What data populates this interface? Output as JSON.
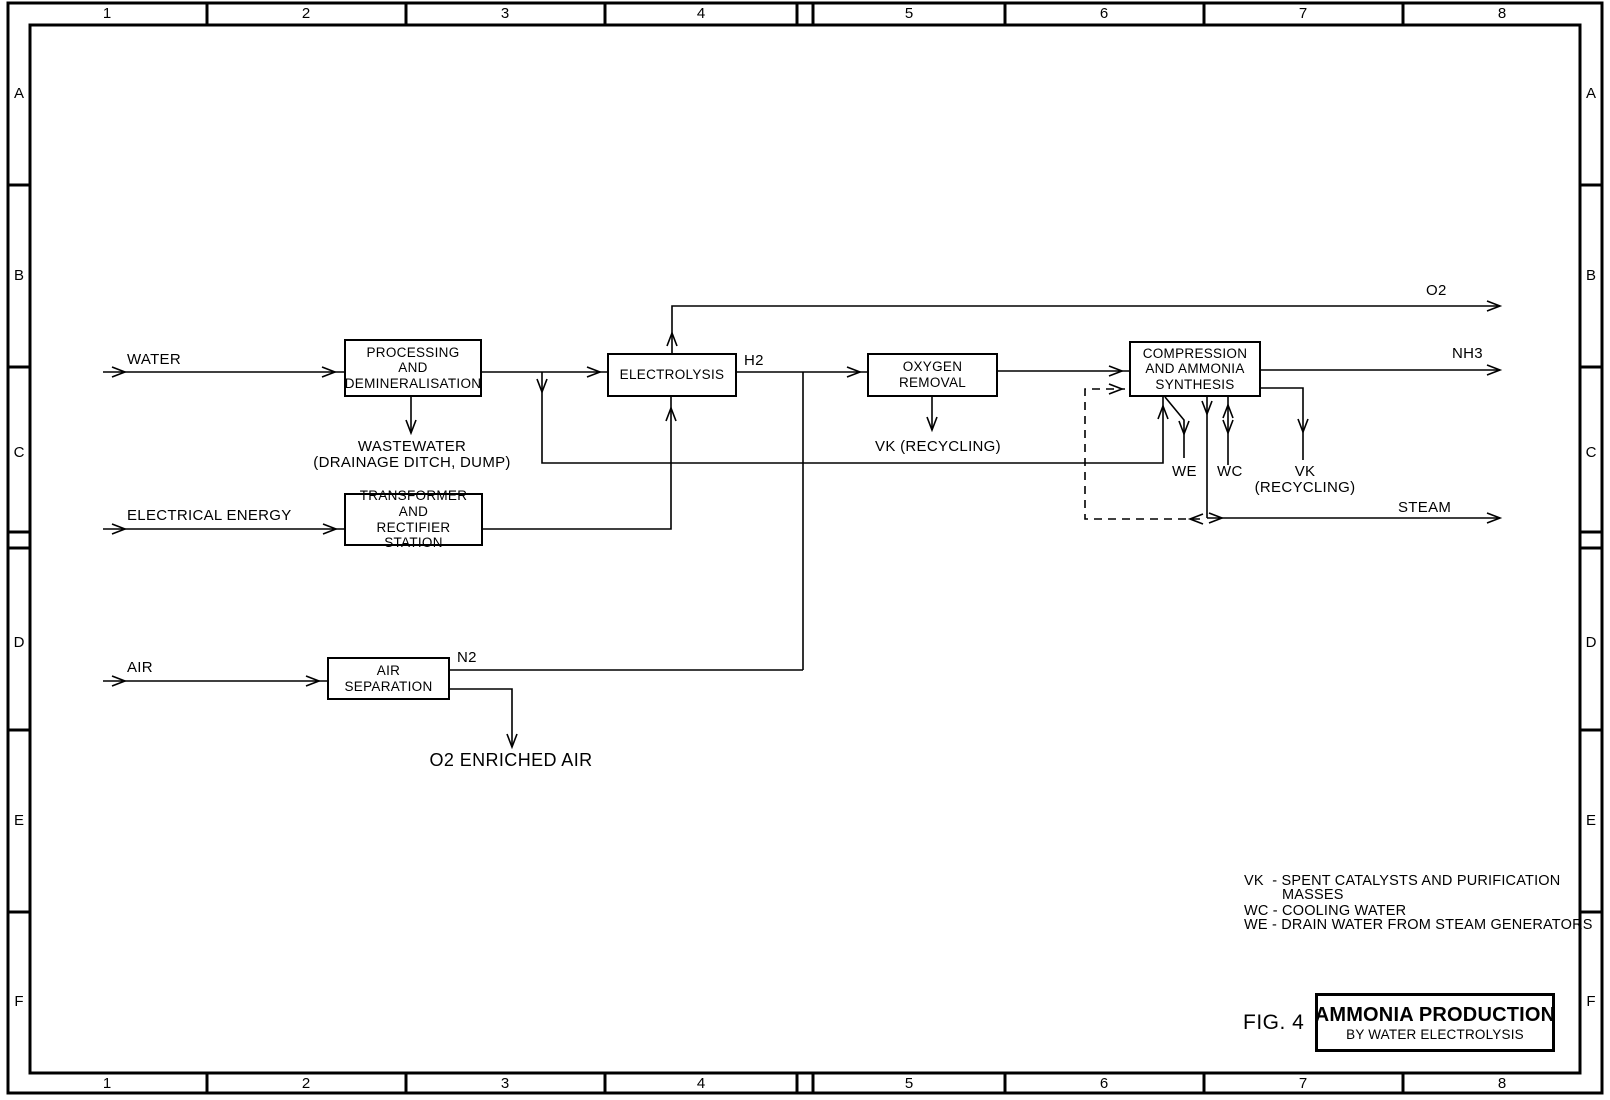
{
  "frame": {
    "top_numbers": [
      "1",
      "2",
      "3",
      "4",
      "5",
      "6",
      "7",
      "8"
    ],
    "bottom_numbers": [
      "1",
      "2",
      "3",
      "4",
      "5",
      "6",
      "7",
      "8"
    ],
    "left_letters": [
      "A",
      "B",
      "C",
      "D",
      "E",
      "F"
    ],
    "right_letters": [
      "A",
      "B",
      "C",
      "D",
      "E",
      "F"
    ]
  },
  "boxes": {
    "processing": {
      "line1": "PROCESSING",
      "line2": "AND",
      "line3": "DEMINERALISATION"
    },
    "electrolysis": {
      "line1": "ELECTROLYSIS"
    },
    "oxygen_removal": {
      "line1": "OXYGEN",
      "line2": "REMOVAL"
    },
    "compression": {
      "line1": "COMPRESSION",
      "line2": "AND AMMONIA",
      "line3": "SYNTHESIS"
    },
    "transformer": {
      "line1": "TRANSFORMER",
      "line2": "AND",
      "line3": "RECTIFIER STATION"
    },
    "air_separation": {
      "line1": "AIR",
      "line2": "SEPARATION"
    }
  },
  "labels": {
    "water": "WATER",
    "electrical_energy": "ELECTRICAL ENERGY",
    "air": "AIR",
    "h2": "H2",
    "n2": "N2",
    "o2": "O2",
    "nh3": "NH3",
    "steam": "STEAM",
    "wastewater_line1": "WASTEWATER",
    "wastewater_line2": "(DRAINAGE DITCH, DUMP)",
    "vk_recycling_mid": "VK (RECYCLING)",
    "we": "WE",
    "wc": "WC",
    "vk": "VK",
    "vk_recycling_paren": "(RECYCLING)",
    "o2_enriched_air": "O2 ENRICHED AIR"
  },
  "legend": {
    "line1": "VK  - SPENT CATALYSTS AND PURIFICATION",
    "line2": "MASSES",
    "line3": "WC - COOLING WATER",
    "line4": "WE - DRAIN WATER FROM STEAM GENERATORS"
  },
  "title_block": {
    "fig": "FIG. 4",
    "title": "AMMONIA PRODUCTION",
    "subtitle": "BY WATER ELECTROLYSIS"
  },
  "colors": {
    "line": "#000000",
    "background": "#ffffff"
  }
}
